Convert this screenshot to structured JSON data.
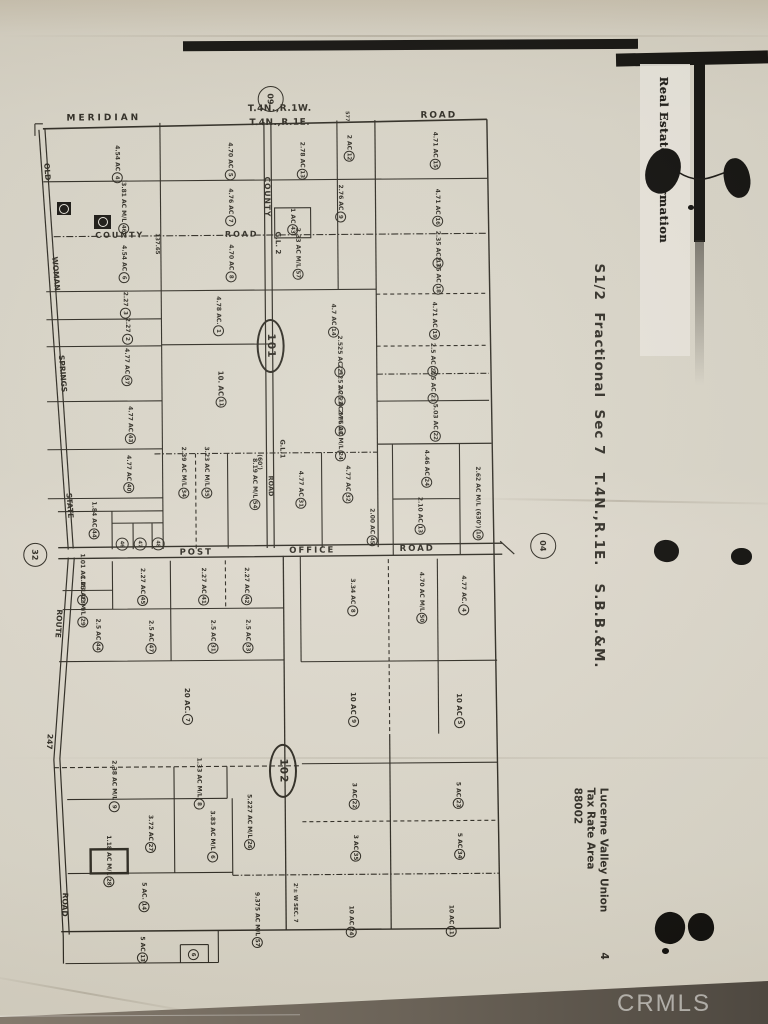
{
  "photo": {
    "watermark": "CRMLS",
    "stamp_text": "Real Estate Information",
    "side_title": "S1/2  Fractional  Sec 7   T.4N.,R.1E.   S.B.B.&M.",
    "tax_area": {
      "line1": "Lucerne Valley Union",
      "line2": "Tax Rate Area",
      "line3": "88002",
      "page": "4"
    }
  },
  "map": {
    "ink": "#2a271f",
    "texts": [
      {
        "t": "MERIDIAN",
        "x": 107,
        "y": 117,
        "rot": 0,
        "s": 9,
        "ls": 3,
        "name": "road-label-meridian"
      },
      {
        "t": "T.4N.,R.1W.",
        "x": 283,
        "y": 109,
        "rot": 0,
        "s": 9,
        "ls": 0.5,
        "name": "township-label-north"
      },
      {
        "t": "T.4N.,R.1E.",
        "x": 283,
        "y": 123,
        "rot": 0,
        "s": 9,
        "ls": 0.5,
        "name": "township-label-south"
      },
      {
        "t": "ROAD",
        "x": 442,
        "y": 117,
        "rot": 0,
        "s": 9,
        "ls": 2,
        "name": "road-label-top"
      },
      {
        "t": "COUNTY",
        "x": 122,
        "y": 234,
        "rot": 0,
        "s": 8,
        "ls": 2,
        "name": "road-label-county"
      },
      {
        "t": "ROAD",
        "x": 244,
        "y": 234,
        "rot": 0,
        "s": 8,
        "ls": 2,
        "name": "road-label-county-road"
      },
      {
        "t": "COUNTY",
        "x": 270,
        "y": 197,
        "rot": 90,
        "s": 7.5,
        "ls": 1,
        "name": "road-label-county-vert"
      },
      {
        "t": "G.L. 2",
        "x": 280,
        "y": 243,
        "rot": 90,
        "s": 7,
        "name": "lot-label-gl2"
      },
      {
        "t": "137.65",
        "x": 159,
        "y": 243,
        "rot": 90,
        "s": 5.5,
        "name": "dimension-label"
      },
      {
        "t": "577",
        "x": 350,
        "y": 117,
        "rot": 90,
        "s": 5,
        "name": "dimension-label"
      },
      {
        "t": "G.L.1",
        "x": 283,
        "y": 449,
        "rot": 90,
        "s": 6.5,
        "name": "road-label-gl1"
      },
      {
        "t": "(60')",
        "x": 260,
        "y": 462,
        "rot": 90,
        "s": 6,
        "name": "dimension-label"
      },
      {
        "t": "ROAD",
        "x": 271,
        "y": 486,
        "rot": 90,
        "s": 6.5,
        "name": "road-label-gl1-road"
      },
      {
        "t": "POST",
        "x": 196,
        "y": 552,
        "rot": 0,
        "s": 8.5,
        "ls": 2,
        "name": "road-label-post"
      },
      {
        "t": "OFFICE",
        "x": 312,
        "y": 551,
        "rot": 0,
        "s": 8.5,
        "ls": 2,
        "name": "road-label-office"
      },
      {
        "t": "ROAD",
        "x": 417,
        "y": 550,
        "rot": 0,
        "s": 8.5,
        "ls": 2,
        "name": "road-label-post-office-road"
      },
      {
        "t": "OLD",
        "x": 50,
        "y": 170,
        "rot": 86,
        "s": 7.5,
        "name": "road-label-old"
      },
      {
        "t": "WOMAN",
        "x": 58,
        "y": 272,
        "rot": 86,
        "s": 7.5,
        "name": "road-label-woman"
      },
      {
        "t": "SPRINGS",
        "x": 64,
        "y": 372,
        "rot": 86,
        "s": 7.5,
        "name": "road-label-springs"
      },
      {
        "t": "STATE",
        "x": 70,
        "y": 504,
        "rot": 86,
        "s": 7.5,
        "name": "road-label-state"
      },
      {
        "t": "ROUTE",
        "x": 58,
        "y": 622,
        "rot": 94,
        "s": 7.5,
        "name": "road-label-route"
      },
      {
        "t": "247",
        "x": 48,
        "y": 740,
        "rot": 94,
        "s": 7.5,
        "name": "road-label-247"
      },
      {
        "t": "ROAD",
        "x": 62,
        "y": 903,
        "rot": 92,
        "s": 7.5,
        "name": "road-label-left-road"
      },
      {
        "t": "2'± W SEC. 7",
        "x": 292,
        "y": 903,
        "rot": 90,
        "s": 5.5,
        "name": "section-line-note"
      }
    ],
    "circles": [
      {
        "n": "09",
        "x": 274,
        "y": 99,
        "r": 12,
        "f": 8
      },
      {
        "n": "32",
        "x": 35,
        "y": 553,
        "r": 11,
        "f": 8
      },
      {
        "n": "04",
        "x": 543,
        "y": 548,
        "r": 12,
        "f": 8
      },
      {
        "n": "46",
        "x": 122,
        "y": 543,
        "r": 5.5,
        "f": 5
      },
      {
        "n": "47",
        "x": 140,
        "y": 543,
        "r": 5.5,
        "f": 5
      },
      {
        "n": "48",
        "x": 158,
        "y": 543,
        "r": 5.5,
        "f": 5
      }
    ],
    "shields": [
      {
        "n": "101",
        "x": 272,
        "y": 346
      },
      {
        "n": "102",
        "x": 281,
        "y": 771
      }
    ],
    "parcels": [
      {
        "n": "4",
        "a": "4.54 AC",
        "x": 120,
        "y": 163
      },
      {
        "n": "5",
        "a": "4.70 AC",
        "x": 233,
        "y": 161
      },
      {
        "n": "13",
        "a": "2.78 AC",
        "x": 305,
        "y": 161
      },
      {
        "n": "12",
        "a": "2 AC",
        "x": 352,
        "y": 149
      },
      {
        "n": "15",
        "a": "4.71 AC",
        "x": 438,
        "y": 152
      },
      {
        "n": "46",
        "a": "3.81 AC M/L",
        "x": 126,
        "y": 207
      },
      {
        "n": "7",
        "a": "4.76 AC",
        "x": 233,
        "y": 207
      },
      {
        "n": "9",
        "a": "2.76 AC",
        "x": 343,
        "y": 204
      },
      {
        "n": "43",
        "a": "1 AC",
        "x": 295,
        "y": 222
      },
      {
        "n": "16",
        "a": "4.71 AC",
        "x": 440,
        "y": 209
      },
      {
        "n": "6",
        "a": "4.54 AC",
        "x": 126,
        "y": 263
      },
      {
        "n": "8",
        "a": "4.70 AC",
        "x": 233,
        "y": 263
      },
      {
        "n": "57",
        "a": "2.33 AC M/L",
        "x": 300,
        "y": 254
      },
      {
        "n": "17",
        "a": "2.35 AC",
        "x": 440,
        "y": 251
      },
      {
        "n": "18",
        "a": "2.35 AC",
        "x": 440,
        "y": 277
      },
      {
        "n": "3",
        "a": "2.27",
        "x": 127,
        "y": 304
      },
      {
        "n": "2",
        "a": "2.27",
        "x": 129,
        "y": 330
      },
      {
        "n": "1",
        "a": "4.78 AC.",
        "x": 220,
        "y": 316
      },
      {
        "n": "14",
        "a": "4.7 AC",
        "x": 335,
        "y": 321
      },
      {
        "n": "19",
        "a": "4.71 AC",
        "x": 436,
        "y": 322
      },
      {
        "n": "21",
        "a": "2.525 AC",
        "x": 341,
        "y": 357
      },
      {
        "n": "20",
        "a": "2.5 AC",
        "x": 434,
        "y": 361
      },
      {
        "n": "22",
        "a": "2.525 AC",
        "x": 341,
        "y": 386
      },
      {
        "n": "21",
        "a": "2.5 AC",
        "x": 434,
        "y": 388
      },
      {
        "n": "23",
        "a": "2.25 AC M/L",
        "x": 341,
        "y": 411
      },
      {
        "n": "24",
        "a": "2.76 AC M/L",
        "x": 341,
        "y": 436
      },
      {
        "n": "22",
        "a": "5.03 AC",
        "x": 436,
        "y": 424
      },
      {
        "n": "37",
        "a": "4.77 AC",
        "x": 128,
        "y": 366
      },
      {
        "n": "11",
        "a": "10. AC",
        "x": 222,
        "y": 389,
        "s": 7
      },
      {
        "n": "43",
        "a": "4.77 AC",
        "x": 131,
        "y": 424
      },
      {
        "n": "40",
        "a": "4.77 AC",
        "x": 129,
        "y": 473
      },
      {
        "n": "34",
        "a": "2.39 AC M/L",
        "x": 184,
        "y": 472
      },
      {
        "n": "35",
        "a": "3.23 AC M/L",
        "x": 207,
        "y": 472
      },
      {
        "n": "54",
        "a": "8.19 AC M/L",
        "x": 255,
        "y": 484
      },
      {
        "n": "31",
        "a": "4.77 AC",
        "x": 301,
        "y": 490
      },
      {
        "n": "32",
        "a": "4.77 AC",
        "x": 348,
        "y": 485
      },
      {
        "n": "24",
        "a": "4.46 AC",
        "x": 427,
        "y": 470
      },
      {
        "n": "10",
        "a": "2.62 AC M/L (630')",
        "x": 478,
        "y": 505
      },
      {
        "n": "13",
        "a": "2.10 AC",
        "x": 420,
        "y": 517
      },
      {
        "n": "44",
        "a": "1.84 AC",
        "x": 94,
        "y": 519
      },
      {
        "n": "45",
        "a": "2.00 AC",
        "x": 372,
        "y": 528
      },
      {
        "n": "28",
        "a": "1.01 AC M/L",
        "x": 82,
        "y": 578
      },
      {
        "n": "29",
        "a": "1.23 AC M/L",
        "x": 82,
        "y": 600
      },
      {
        "n": "45",
        "a": "2.27 AC",
        "x": 142,
        "y": 586
      },
      {
        "n": "41",
        "a": "2.27 AC",
        "x": 203,
        "y": 586
      },
      {
        "n": "42",
        "a": "2.27 AC",
        "x": 246,
        "y": 586
      },
      {
        "n": "8",
        "a": "3.34 AC",
        "x": 352,
        "y": 598
      },
      {
        "n": "50",
        "a": "4.70 AC M/L",
        "x": 421,
        "y": 599
      },
      {
        "n": "4",
        "a": "4.77 AC.",
        "x": 463,
        "y": 597
      },
      {
        "n": "44",
        "a": "2.5 AC",
        "x": 97,
        "y": 634
      },
      {
        "n": "47",
        "a": "2.5 AC",
        "x": 150,
        "y": 636
      },
      {
        "n": "31",
        "a": "2.5 AC",
        "x": 212,
        "y": 636
      },
      {
        "n": "33",
        "a": "2.5 AC",
        "x": 247,
        "y": 636
      },
      {
        "n": "7",
        "a": "20 AC.",
        "x": 186,
        "y": 706,
        "s": 7
      },
      {
        "n": "9",
        "a": "10 AC",
        "x": 352,
        "y": 710,
        "s": 7
      },
      {
        "n": "5",
        "a": "10 AC",
        "x": 458,
        "y": 712,
        "s": 7
      },
      {
        "n": "9",
        "a": "2.38 AC M/L",
        "x": 112,
        "y": 785
      },
      {
        "n": "8",
        "a": "1.33 AC M/L",
        "x": 197,
        "y": 783
      },
      {
        "n": "26",
        "a": "5.227 AC M/L",
        "x": 247,
        "y": 822
      },
      {
        "n": "27",
        "a": "3.72 AC",
        "x": 148,
        "y": 833
      },
      {
        "n": "6",
        "a": "3.83 AC M/L",
        "x": 210,
        "y": 836
      },
      {
        "n": "28",
        "a": "1.18 AC M/L",
        "x": 106,
        "y": 860
      },
      {
        "n": "22",
        "a": "3 AC",
        "x": 352,
        "y": 797
      },
      {
        "n": "23",
        "a": "5 AC",
        "x": 456,
        "y": 797
      },
      {
        "n": "35",
        "a": "3 AC",
        "x": 353,
        "y": 849
      },
      {
        "n": "34",
        "a": "5 AC",
        "x": 457,
        "y": 848
      },
      {
        "n": "14",
        "a": "5 AC.",
        "x": 141,
        "y": 896
      },
      {
        "n": "57",
        "a": "9.375 AC M/L",
        "x": 254,
        "y": 920
      },
      {
        "n": "24",
        "a": "10 AC",
        "x": 348,
        "y": 922
      },
      {
        "n": "11",
        "a": "10 AC",
        "x": 448,
        "y": 922
      },
      {
        "n": "13",
        "a": "5 AC",
        "x": 139,
        "y": 949
      },
      {
        "n": "6",
        "a": "",
        "x": 190,
        "y": 954
      }
    ]
  }
}
